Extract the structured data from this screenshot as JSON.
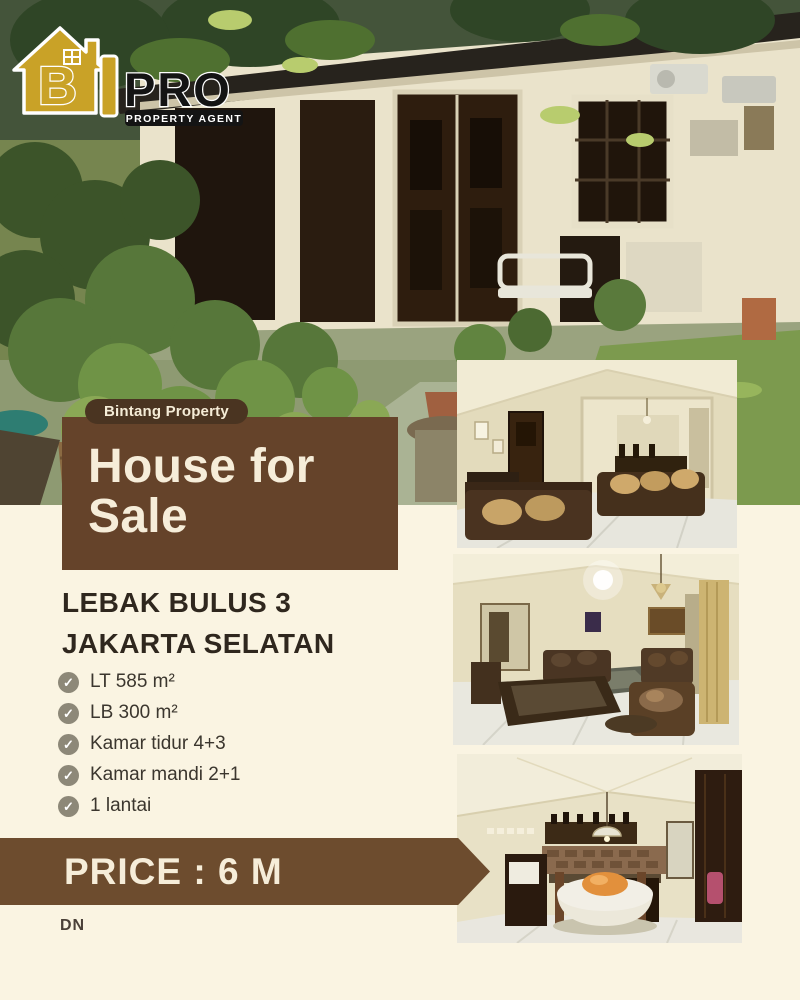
{
  "brand": {
    "house_letter": "B",
    "pro": "PRO",
    "tagline": "PROPERTY AGENT"
  },
  "badge_label": "Bintang Property",
  "title": {
    "line1": "House for",
    "line2": "Sale"
  },
  "location": {
    "line1": "LEBAK BULUS 3",
    "line2": "JAKARTA SELATAN"
  },
  "features": [
    {
      "icon": "check-circle",
      "label": "LT 585 m²"
    },
    {
      "icon": "check-circle",
      "label": "LB 300 m²"
    },
    {
      "icon": "check-circle",
      "label": "Kamar tidur 4+3"
    },
    {
      "icon": "check-circle",
      "label": "Kamar mandi 2+1"
    },
    {
      "icon": "check-circle",
      "label": "1 lantai"
    }
  ],
  "price": {
    "label": "PRICE : 6 M"
  },
  "footer": {
    "initials": "DN"
  },
  "check_glyph": "✓",
  "photos": {
    "exterior": "house-exterior-with-garden",
    "interior_1": "living-room-photo-1",
    "interior_2": "living-room-photo-2",
    "interior_3": "kitchen-dining-photo"
  },
  "colors": {
    "cream_background": "#faf4e2",
    "title_box_brown": "#65432a",
    "badge_brown": "#4a3421",
    "price_banner_brown": "#6d4c2e",
    "heading_text": "#2f271e",
    "cream_text": "#f6edd9",
    "check_icon": "#8d8878",
    "logo_gold": "#c9a227"
  }
}
